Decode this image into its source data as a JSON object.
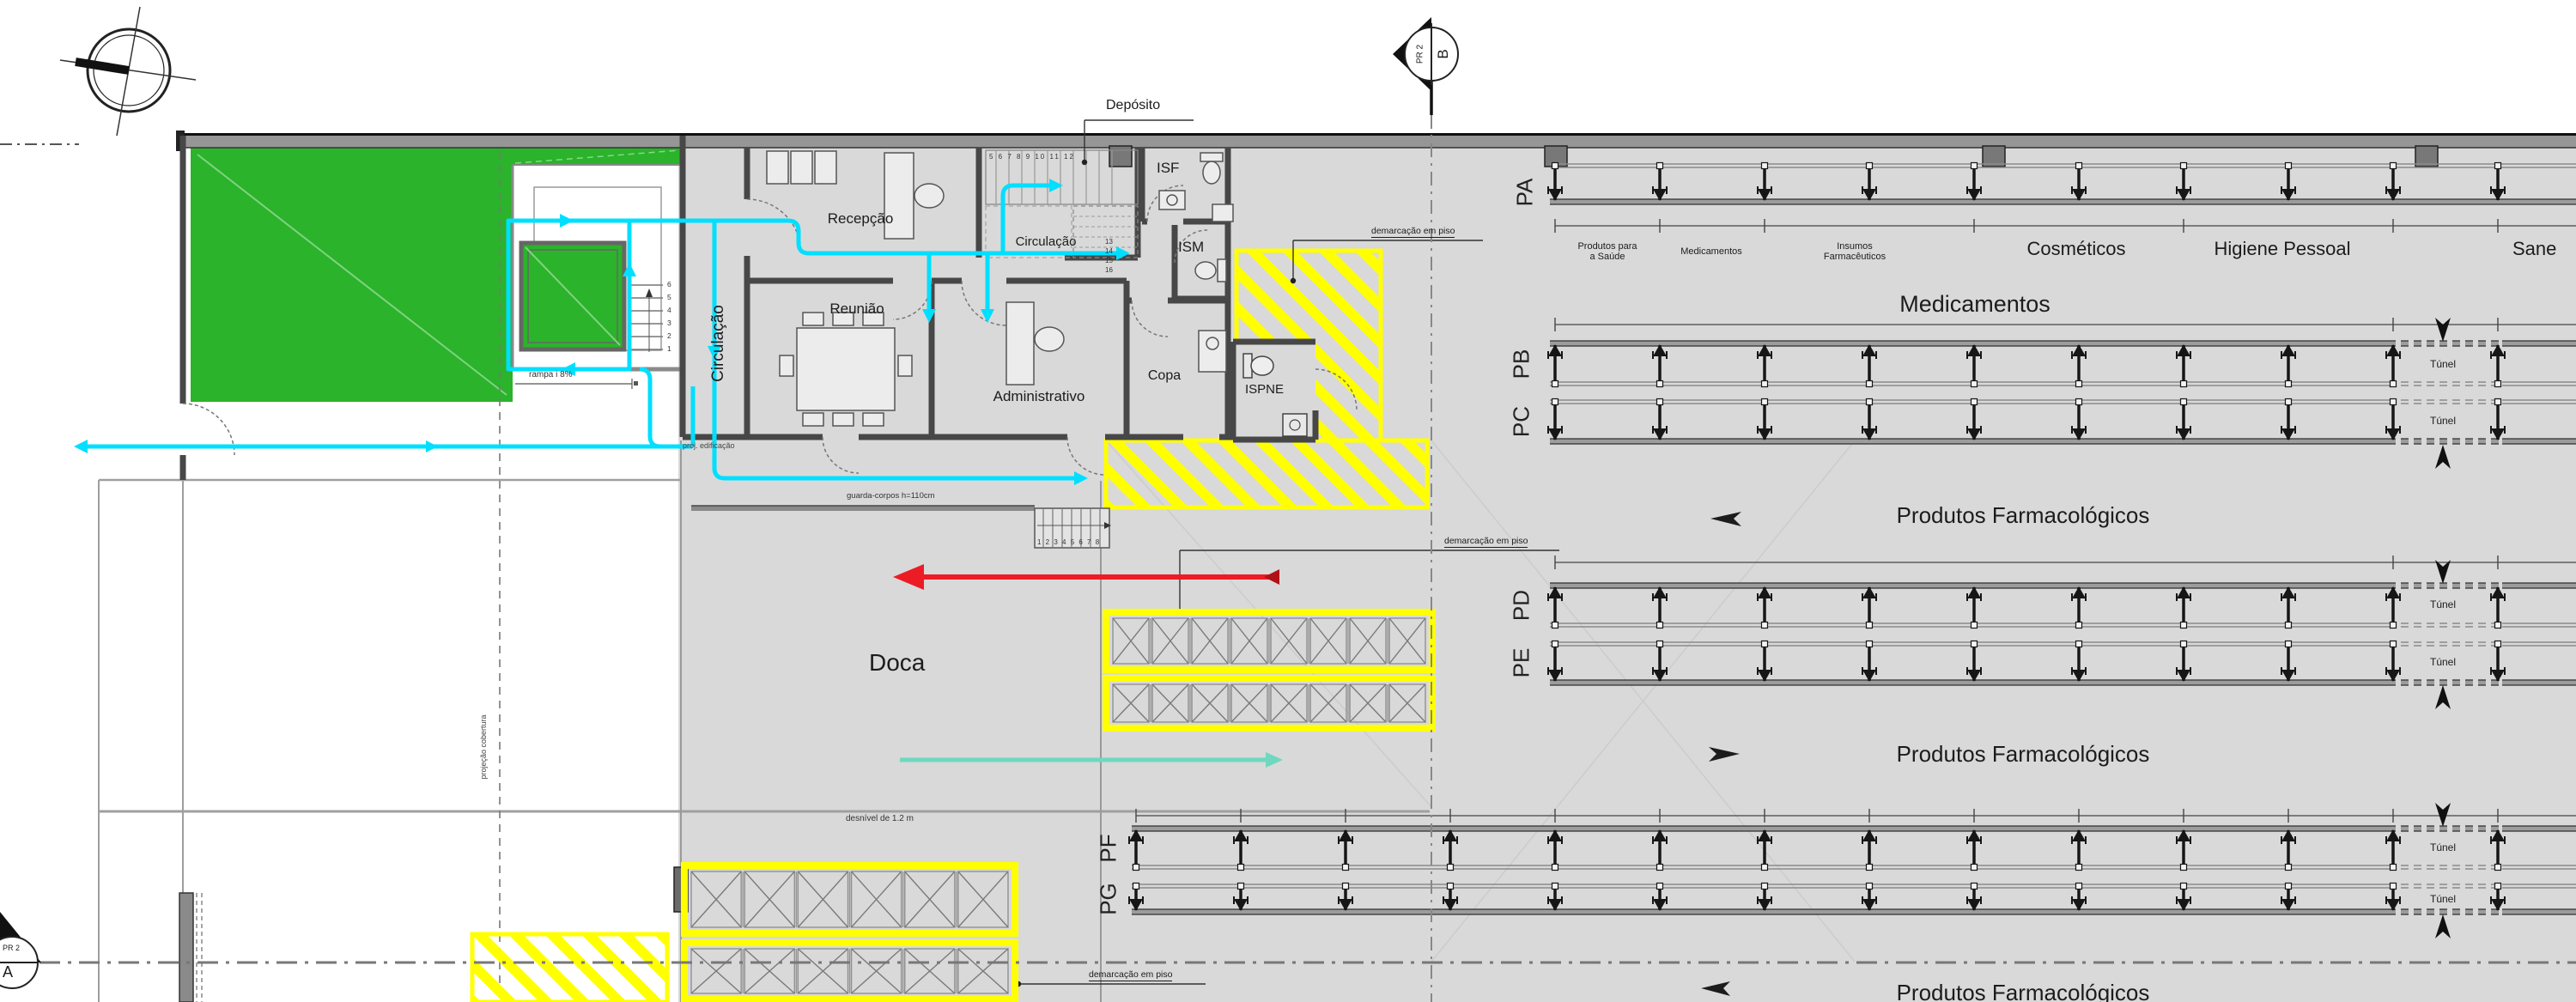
{
  "colors": {
    "floor": "#d9d9d9",
    "wall": "#4a4a4a",
    "green": "#2bb32b",
    "cyan": "#00dfff",
    "yellow": "#ffff00",
    "red": "#ec1c24",
    "teal": "#6fd8bf"
  },
  "section_markers": {
    "top": {
      "code": "PR 2",
      "face": "B"
    },
    "bottom": {
      "code": "PR 2",
      "face": "A"
    }
  },
  "rooms": {
    "recepcao": "Recepção",
    "circulacao_corridor": "Circulação",
    "circulacao_hall": "Circulação",
    "reuniao": "Reunião",
    "administrativo": "Administrativo",
    "copa": "Copa",
    "isf": "ISF",
    "ism": "ISM",
    "ispne": "ISPNE",
    "deposito": "Depósito",
    "doca": "Doca"
  },
  "annotations": {
    "demarcacao_piso_top": "demarcação em piso",
    "demarcacao_piso_mid": "demarcação em piso",
    "demarcacao_piso_bottom": "demarcação em piso",
    "proj_edificacao": "proj. edificação",
    "guarda_corpos": "guarda-corpos h=110cm",
    "desnivel": "desnível de 1.2 m",
    "rampa": "rampa i 8%",
    "projecao_cobertura": "projeção cobertura"
  },
  "stair_numbers": {
    "internal_upper": "5 6 7 8 9 10 11 12",
    "internal_side": "13 14 15 16",
    "garden": "6 5 4 3 2 1",
    "dock": "1 2 3 4 5 6 7 8"
  },
  "warehouse": {
    "row_labels": [
      "PA",
      "PB",
      "PC",
      "PD",
      "PE",
      "PF",
      "PG"
    ],
    "tunnel_label": "Túnel",
    "sections_small": [
      "Produtos para\na Saúde",
      "Medicamentos",
      "Insumos\nFarmacêuticos"
    ],
    "sections_large": [
      "Cosméticos",
      "Higiene Pessoal",
      "Sane"
    ],
    "zone_titles": {
      "medicamentos": "Medicamentos",
      "farmacologicos_upper": "Produtos Farmacológicos",
      "farmacologicos_lower": "Produtos Farmacológicos",
      "farmacologicos_bottom": "Produtos Farmacológicos"
    }
  }
}
